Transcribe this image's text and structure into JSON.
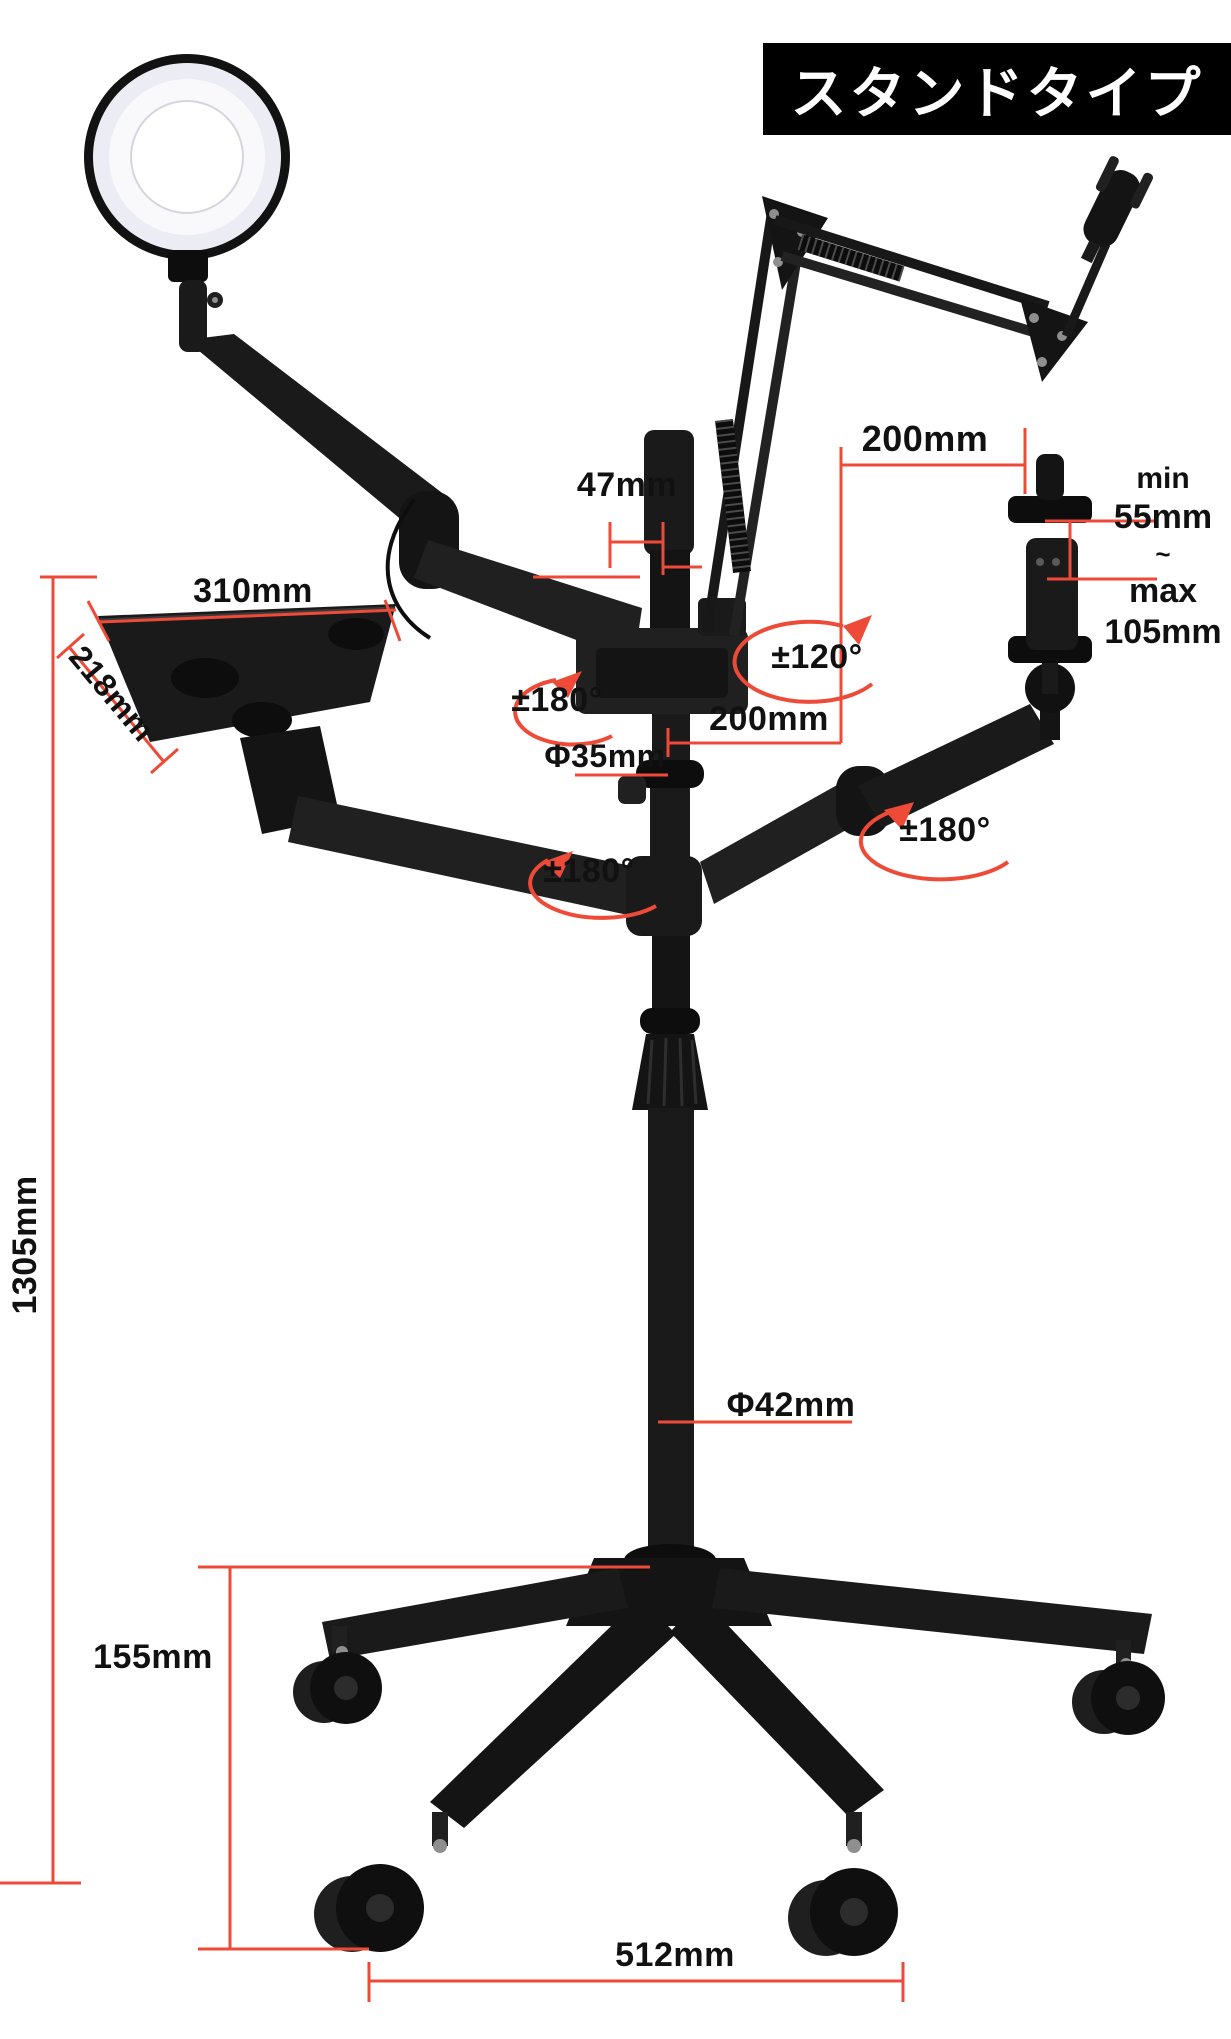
{
  "title_badge": {
    "text": "スタンドタイプ"
  },
  "dimensions": {
    "boom_reach_top": "200mm",
    "phone_min_label": "min",
    "phone_min_value": "55mm",
    "phone_range_tilde": "~",
    "phone_max_label": "max",
    "phone_max_value": "105mm",
    "pole_top_diameter": "47mm",
    "tablet_width": "310mm",
    "tablet_depth": "218mm",
    "arm_reach_center": "200mm",
    "upper_pole_diameter": "Φ35mm",
    "lower_pole_diameter": "Φ42mm",
    "pole_height": "1305mm",
    "base_height": "155mm",
    "base_width": "512mm"
  },
  "rotations": {
    "boom_swivel": "±120°",
    "top_arm_swivel": "±180°",
    "phone_arm_swivel": "±180°",
    "tablet_arm_swivel": "±180°"
  },
  "colors": {
    "annotation_red": "#ee4a38",
    "label_black": "#111111",
    "title_bg": "#000000",
    "title_fg": "#ffffff"
  }
}
